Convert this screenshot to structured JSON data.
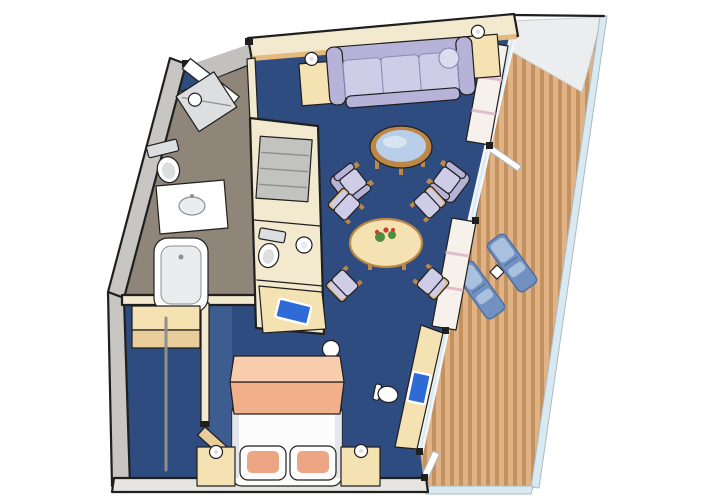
{
  "scene": {
    "type": "cruise-ship-suite-floor-plan",
    "rooms": [
      {
        "name": "living-room",
        "floor": "navy-carpet",
        "items": [
          "sofa",
          "end-table-left",
          "end-table-right",
          "table-lamp-left",
          "table-lamp-right",
          "round-glass-coffee-table",
          "armchair-left",
          "armchair-right",
          "dining-table-with-flowers",
          "dining-chair-nw",
          "dining-chair-ne",
          "dining-chair-sw",
          "dining-chair-se",
          "wall-shelving-unit"
        ]
      },
      {
        "name": "bedroom",
        "floor": "navy-carpet",
        "items": [
          "double-bed",
          "folded-blanket",
          "pillow-left",
          "pillow-right",
          "nightstand-left",
          "nightstand-right",
          "bedside-lamp-left",
          "bedside-lamp-right",
          "desk-with-tv",
          "desk-chair",
          "balcony-door"
        ]
      },
      {
        "name": "bathroom",
        "floor": "taupe-tile",
        "items": [
          "shower-stall",
          "toilet",
          "washbasin-counter",
          "bathtub"
        ]
      },
      {
        "name": "water-closet",
        "items": [
          "linen-shelves",
          "toilet",
          "washbasin",
          "tv-cabinet",
          "stool"
        ]
      },
      {
        "name": "walk-in-closet",
        "items": [
          "shelf",
          "hanging-rail",
          "wood-door"
        ]
      },
      {
        "name": "balcony",
        "floor": "teak-deck",
        "items": [
          "lounge-chair-1",
          "lounge-chair-2",
          "side-table",
          "glass-railing",
          "overhang",
          "balcony-door"
        ]
      },
      {
        "name": "entrance",
        "items": [
          "entry-door"
        ]
      }
    ]
  },
  "colors": {
    "page": "#ffffff",
    "outline": "#1f1f1f",
    "carpet": "#2e4c7f",
    "carpet_light": "#3d5d90",
    "wall": "#f2e9cf",
    "wall_gray": "#c7c6c2",
    "wall_gray_light": "#e6e5e2",
    "bath_floor": "#8f8679",
    "entry_floor": "#c2c1bd",
    "white": "#ffffff",
    "fixture_gray": "#dcdedf",
    "fixture_line": "#8b9093",
    "tub_inner": "#e9edee",
    "sofa": "#b7b3d8",
    "sofa_light": "#dddbee",
    "sofa_dark": "#8e8ab8",
    "cushion": "#cecce6",
    "wood": "#bd8748",
    "wood_light": "#e3b97e",
    "cream": "#f4e2b3",
    "glass": "#b9cfe9",
    "glass_frame": "#f4f6f7",
    "deck": "#e0b286",
    "deck_stripe": "#c3935f",
    "lounge": "#7191c1",
    "lounge_dark": "#4f6f9e",
    "lounge_light": "#a9c1de",
    "rail_glass": "#d8e9f2",
    "rail_edge": "#a9bac4",
    "overhang": "#ebedee",
    "bed_white": "#fcfcfd",
    "bed_shadow": "#dfe0e6",
    "blanket": "#f2b08a",
    "blanket_light": "#f8cdae",
    "pillow": "#eda684",
    "tv": "#2f6bd7",
    "shelf_white": "#f6f1ea",
    "shelf_pink": "#e2bcc9",
    "gray_box": "#c2c2bf",
    "door_wood": "#e8cd9a",
    "rod_gray": "#8f8f8d",
    "flower_green": "#4e8c3f",
    "flower_red": "#cf3b30"
  }
}
